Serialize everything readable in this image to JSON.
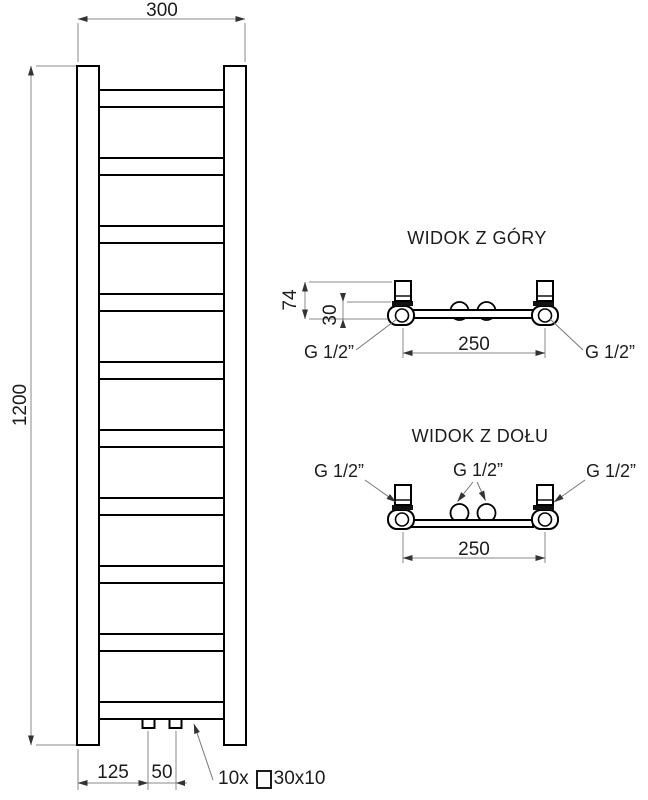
{
  "front_view": {
    "dims": {
      "width": "300",
      "height": "1200",
      "offset_left": "125",
      "stub_spacing": "50"
    },
    "profile": {
      "count_label": "10x",
      "size_label": "30x10"
    }
  },
  "top_view": {
    "title": "WIDOK Z GÓRY",
    "dims": {
      "bracket_depth": "74",
      "pipe_offset": "30",
      "connection_spacing": "250"
    },
    "labels": {
      "left": "G 1/2”",
      "right": "G 1/2”"
    }
  },
  "bottom_view": {
    "title": "WIDOK Z DOŁU",
    "dims": {
      "connection_spacing": "250"
    },
    "labels": {
      "left": "G 1/2”",
      "center": "G 1/2”",
      "right": "G 1/2”"
    }
  },
  "colors": {
    "object_line": "#000000",
    "dimension_line": "#8a8a8a",
    "text": "#1c1c1c",
    "background": "#ffffff"
  }
}
